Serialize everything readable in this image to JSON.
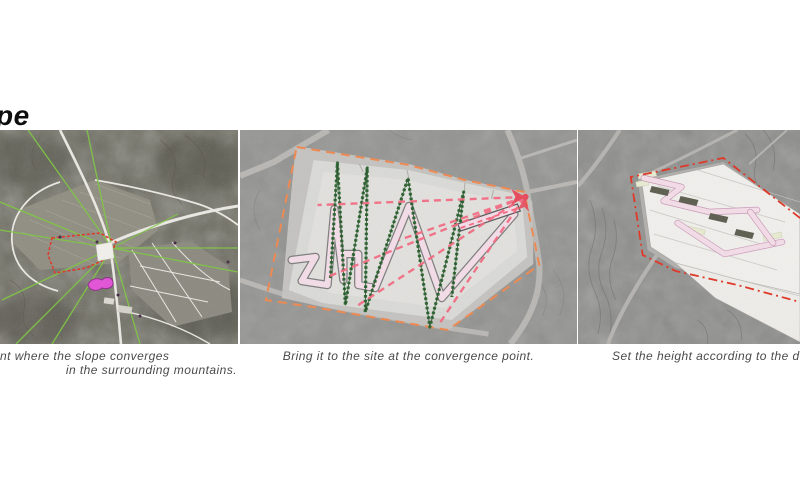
{
  "title": {
    "text": "pe"
  },
  "captions": {
    "left_line1": "nt where the slope converges",
    "left_line2": "in the surrounding mountains.",
    "middle": "Bring it to the site at the convergence point.",
    "right": "Set the height according to the d"
  },
  "panels": [
    {
      "name": "satellite-map-slope-convergence"
    },
    {
      "name": "site-plan-convergence-point"
    },
    {
      "name": "massing-model-height"
    }
  ],
  "colors": {
    "green": "#7cc63e",
    "darkgreen": "#2e6a33",
    "red": "#e03222",
    "magenta": "#e44fd8",
    "orange": "#f0874d",
    "pink": "#f5677f",
    "ramp-pink": "#f4dde8",
    "red-arrow": "#e8485a",
    "olive": "#5c5c4e",
    "pale-yellow": "#e9ecd2",
    "caption-text": "#4a4a4a",
    "title-text": "#0e0e0e"
  }
}
